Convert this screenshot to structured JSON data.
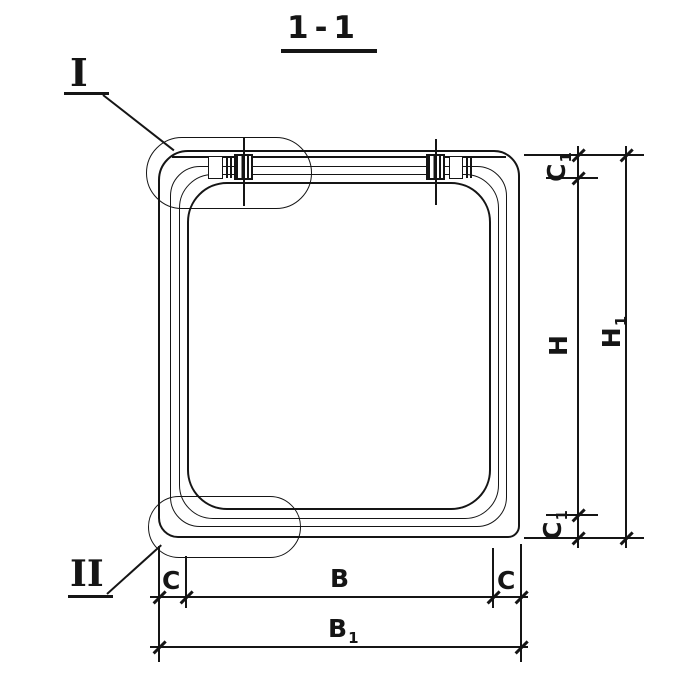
{
  "drawing": {
    "title": "1-1",
    "type_note": "section view of reinforced-concrete culvert link",
    "detail_markers": {
      "first": "I",
      "second": "II"
    },
    "dims": {
      "c_left": "C",
      "b": "B",
      "c_right": "C",
      "b1": {
        "base": "B",
        "sub": "1"
      },
      "c1_top": {
        "base": "C",
        "sub": "1"
      },
      "h": "H",
      "h1": {
        "base": "H",
        "sub": "1"
      },
      "c1_bottom": {
        "base": "C",
        "sub": "1"
      }
    },
    "colors": {
      "ink": "#151515",
      "paper": "#ffffff"
    }
  }
}
